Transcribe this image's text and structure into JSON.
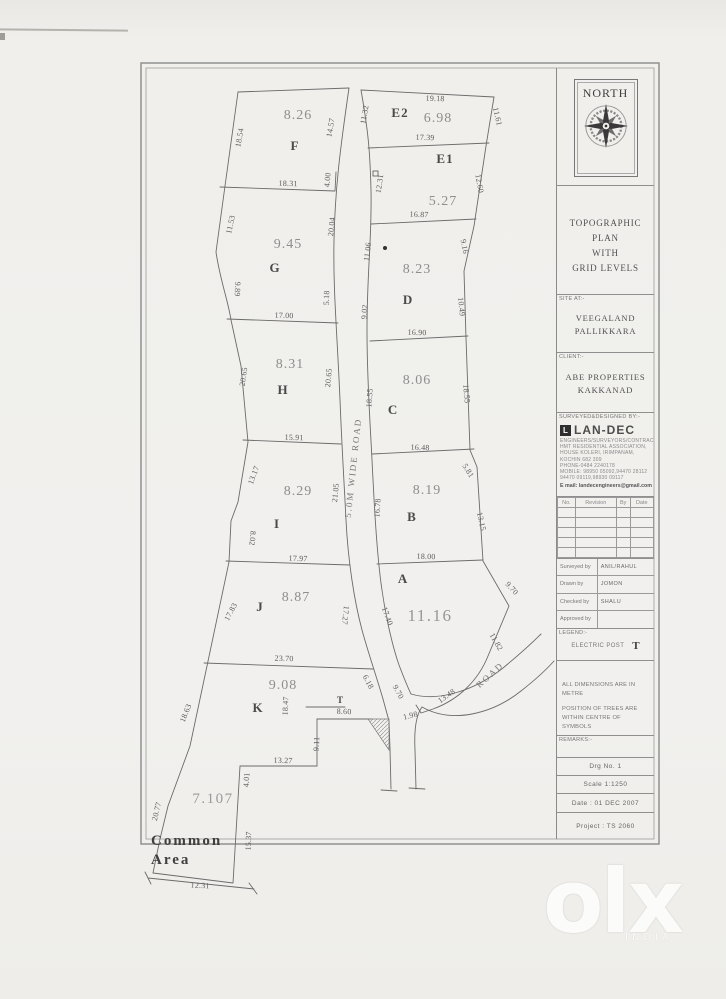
{
  "titleblock": {
    "north_label": "NORTH",
    "title_lines": [
      "TOPOGRAPHIC PLAN",
      "WITH",
      "GRID LEVELS"
    ],
    "site_label": "SITE AT:-",
    "site_lines": [
      "VEEGALAND",
      "PALLIKKARA"
    ],
    "client_label": "CLIENT:-",
    "client_lines": [
      "ABE PROPERTIES",
      "KAKKANAD"
    ],
    "surveyor_label": "SURVEYED&DESIGNED BY:-",
    "company": {
      "name": "LAN-DEC",
      "lines": [
        "ENGINEERS/SURVEYORS/CONTRACTORS",
        "HMT RESIDENTIAL ASSOCIATION,",
        "HOUSE KOLERI, IRIMPANAM,",
        "KOCHIN 682 309",
        "PHONE-0484 2240178",
        "MOBILE: 98950 05092,94470 28112",
        "94470 09119,98930 09117"
      ],
      "email": "E mail: landecengineers@gmail.com"
    },
    "rev_headers": [
      "No.",
      "Revision",
      "By",
      "Date"
    ],
    "signoff_labels": [
      "Surveyed by",
      "Drawn by",
      "Checked by",
      "Approved by"
    ],
    "signoff_values": [
      "ANIL/RAHUL",
      "JOMON",
      "SHALU",
      ""
    ],
    "legend_label": "LEGEND:-",
    "legend_item": "ELECTRIC POST",
    "legend_symbol": "T",
    "notes": [
      "ALL DIMENSIONS ARE IN METRE",
      "POSITION OF TREES ARE",
      "WITHIN CENTRE OF SYMBOLS"
    ],
    "remarks_label": "REMARKS:-",
    "drg_no": "Drg No. 1",
    "scale": "Scale  1:1250",
    "date": "Date : 01 DEC 2007",
    "project": "Project : TS 2060"
  },
  "drawing": {
    "road_labels": [
      [
        "5.0M WIDE ROAD",
        356,
        468,
        -84
      ],
      [
        "ROAD",
        492,
        677,
        -42
      ]
    ],
    "plots": [
      {
        "letter": "F",
        "area": "8.26",
        "letter_pos": [
          295,
          150
        ],
        "area_pos": [
          298,
          119
        ]
      },
      {
        "letter": "G",
        "area": "9.45",
        "letter_pos": [
          275,
          272
        ],
        "area_pos": [
          288,
          248
        ]
      },
      {
        "letter": "H",
        "area": "8.31",
        "letter_pos": [
          283,
          394
        ],
        "area_pos": [
          290,
          368
        ]
      },
      {
        "letter": "I",
        "area": "8.29",
        "letter_pos": [
          277,
          528
        ],
        "area_pos": [
          298,
          495
        ]
      },
      {
        "letter": "J",
        "area": "8.87",
        "letter_pos": [
          260,
          611
        ],
        "area_pos": [
          296,
          601
        ]
      },
      {
        "letter": "K",
        "area": "9.08",
        "letter_pos": [
          258,
          712
        ],
        "area_pos": [
          283,
          689
        ]
      },
      {
        "letter": "E2",
        "area": "6.98",
        "letter_pos": [
          400,
          117
        ],
        "area_pos": [
          438,
          122
        ]
      },
      {
        "letter": "E1",
        "area": "5.27",
        "letter_pos": [
          445,
          163
        ],
        "area_pos": [
          443,
          205
        ]
      },
      {
        "letter": "D",
        "area": "8.23",
        "letter_pos": [
          408,
          304
        ],
        "area_pos": [
          417,
          273
        ]
      },
      {
        "letter": "C",
        "area": "8.06",
        "letter_pos": [
          393,
          414
        ],
        "area_pos": [
          417,
          384
        ]
      },
      {
        "letter": "B",
        "area": "8.19",
        "letter_pos": [
          412,
          521
        ],
        "area_pos": [
          427,
          494
        ]
      },
      {
        "letter": "A",
        "area": "11.16",
        "letter_pos": [
          403,
          583
        ],
        "area_pos": [
          430,
          621
        ],
        "big": true
      }
    ],
    "common_area": {
      "name_lines": [
        "Common",
        "Area"
      ],
      "name_pos": [
        151,
        845
      ],
      "line_height": 19,
      "area": "7.107",
      "area_pos": [
        213,
        803
      ]
    },
    "post_symbol": "T",
    "dims": [
      [
        "18.54",
        242,
        138,
        -80
      ],
      [
        "14.57",
        333,
        128,
        -80
      ],
      [
        "18.31",
        288,
        186,
        2
      ],
      [
        "4.00",
        330,
        180,
        -85
      ],
      [
        "11.53",
        233,
        225,
        -78
      ],
      [
        "9.89",
        235,
        289,
        92
      ],
      [
        "20.04",
        334,
        227,
        -84
      ],
      [
        "5.18",
        329,
        298,
        -88
      ],
      [
        "17.00",
        284,
        318,
        2
      ],
      [
        "20.65",
        246,
        377,
        -82
      ],
      [
        "20.65",
        331,
        378,
        -85
      ],
      [
        "15.91",
        294,
        440,
        2
      ],
      [
        "13.17",
        256,
        476,
        -70
      ],
      [
        "8.02",
        250,
        538,
        95
      ],
      [
        "21.05",
        338,
        493,
        -84
      ],
      [
        "17.97",
        298,
        561,
        2
      ],
      [
        "17.83",
        233,
        613,
        -62
      ],
      [
        "17.27",
        343,
        615,
        96
      ],
      [
        "23.70",
        284,
        661,
        2
      ],
      [
        "18.63",
        188,
        714,
        -68
      ],
      [
        "18.47",
        288,
        706,
        -87
      ],
      [
        "8.60",
        344,
        714,
        2
      ],
      [
        "9.11",
        319,
        744,
        -87
      ],
      [
        "13.27",
        283,
        763,
        2
      ],
      [
        "4.01",
        249,
        780,
        -86
      ],
      [
        "20.77",
        159,
        812,
        -76
      ],
      [
        "15.37",
        251,
        841,
        -88
      ],
      [
        "12.31",
        200,
        888,
        3
      ],
      [
        "17.40",
        385,
        617,
        70
      ],
      [
        "6.18",
        366,
        683,
        62
      ],
      [
        "9.70",
        396,
        693,
        62
      ],
      [
        "1.98",
        411,
        718,
        -14
      ],
      [
        "11.32",
        367,
        115,
        -80
      ],
      [
        "12.31",
        382,
        184,
        -82
      ],
      [
        "11.06",
        370,
        252,
        -83
      ],
      [
        "9.02",
        367,
        312,
        -86
      ],
      [
        "18.55",
        372,
        398,
        -86
      ],
      [
        "16.78",
        380,
        508,
        -86
      ],
      [
        "19.18",
        435,
        101,
        2
      ],
      [
        "17.39",
        425,
        140,
        2
      ],
      [
        "16.87",
        419,
        217,
        2
      ],
      [
        "16.90",
        417,
        335,
        2
      ],
      [
        "16.48",
        420,
        450,
        2
      ],
      [
        "18.00",
        426,
        559,
        2
      ],
      [
        "11.61",
        495,
        117,
        77
      ],
      [
        "12.60",
        477,
        184,
        80
      ],
      [
        "9.16",
        462,
        247,
        79
      ],
      [
        "10.49",
        459,
        307,
        84
      ],
      [
        "18.55",
        464,
        394,
        85
      ],
      [
        "5.81",
        466,
        472,
        58
      ],
      [
        "13.15",
        479,
        522,
        78
      ],
      [
        "9.70",
        510,
        590,
        48
      ],
      [
        "11.82",
        494,
        643,
        60
      ],
      [
        "13.48",
        448,
        698,
        -35
      ]
    ]
  },
  "watermark": {
    "text": "olx",
    "subtext": "INDIA"
  }
}
